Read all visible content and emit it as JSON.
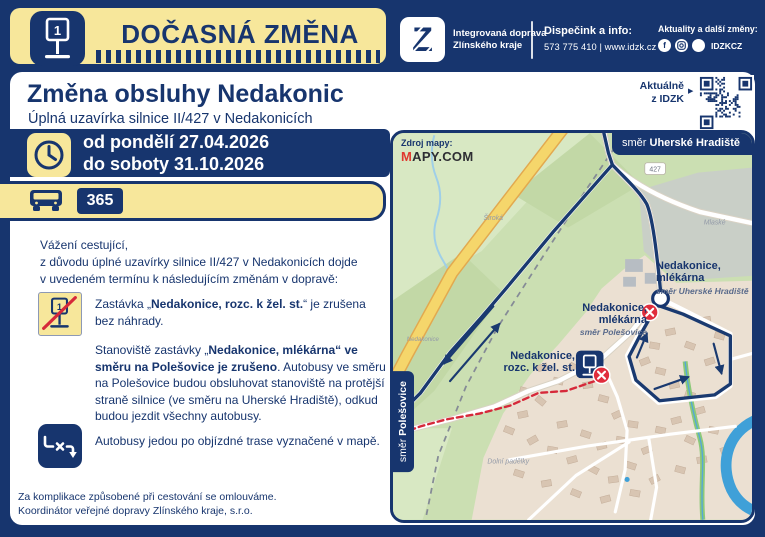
{
  "header": {
    "banner_title": "DOČASNÁ ZMĚNA",
    "brand": {
      "name_line1": "Integrovaná doprava",
      "name_line2": "Zlínského kraje"
    },
    "dispatch": {
      "label": "Dispečink a info:",
      "value": "573 775 410 | www.idzk.cz"
    },
    "news": {
      "label": "Aktuality a další změny:",
      "handle": "IDZKCZ",
      "facebook_glyph": "f"
    }
  },
  "qr": {
    "label_line1": "Aktuálně",
    "label_line2": "z IDZK"
  },
  "notice": {
    "title": "Změna obsluhy Nedakonic",
    "subtitle": "Úplná uzavírka silnice II/427 v Nedakonicích",
    "period": {
      "from": "od pondělí 27.04.2026",
      "to": "do soboty 31.10.2026"
    },
    "line_number": "365",
    "intro": [
      "Vážení cestující,",
      "z důvodu úplné uzavírky silnice II/427 v Nedakonicích dojde",
      "v uvedeném termínu k následujícím změnám v dopravě:"
    ],
    "bullets": [
      {
        "segments": [
          {
            "t": "Zastávka „"
          },
          {
            "t": "Nedakonice, rozc. k žel. st.",
            "b": true
          },
          {
            "t": "“ je zrušena bez náhrady."
          }
        ]
      },
      {
        "segments": [
          {
            "t": "Stanoviště zastávky „"
          },
          {
            "t": "Nedakonice, mlékárna“ ve směru na Polešovice je zrušeno",
            "b": true
          },
          {
            "t": ". Autobusy ve směru na Polešovice budou obsluhovat stanoviště na protější straně silnice (ve směru na Uherské Hradiště), odkud budou jezdit všechny autobusy."
          }
        ]
      },
      {
        "segments": [
          {
            "t": "Autobusy jedou po objízdné trase vyznačené v mapě."
          }
        ]
      }
    ],
    "footer": [
      "Za komplikace způsobené při cestování se omlouváme.",
      "Koordinátor veřejné dopravy Zlínského kraje, s.r.o."
    ]
  },
  "map": {
    "source_label": "Zdroj mapy:",
    "source_logo_m": "M",
    "source_logo_rest": "APY.COM",
    "badge_top": {
      "prefix": "směr ",
      "destination": "Uherské Hradiště"
    },
    "badge_left": {
      "prefix": "směr ",
      "destination": "Polešovice"
    },
    "road_number": "427",
    "stops": [
      {
        "name_line1": "Nedakonice,",
        "name_line2": "mlékárna",
        "direction": "směr Uherské Hradiště",
        "status": "served"
      },
      {
        "name_line1": "Nedakonice,",
        "name_line2": "mlékárna",
        "direction": "směr Polešovice",
        "status": "cancelled"
      },
      {
        "name_line1": "Nedakonice,",
        "name_line2": "rozc. k žel. st.",
        "direction": "",
        "status": "cancelled"
      }
    ],
    "minor_labels": [
      "Široká",
      "Mlaské",
      "Nedakonice",
      "Dolní padělky"
    ]
  },
  "colors": {
    "navy": "#17356E",
    "yellow": "#F7E79B",
    "red": "#E02D3C",
    "map_green": "#CBDFB2"
  }
}
